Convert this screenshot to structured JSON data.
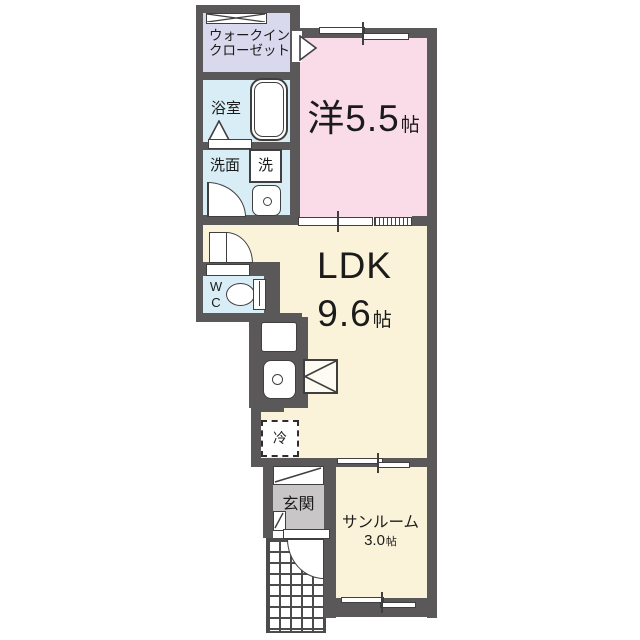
{
  "plan": {
    "type": "japanese-apartment-floorplan",
    "rooms": {
      "walk_in_closet": {
        "line1": "ウォークイン",
        "line2": "クローゼット"
      },
      "bathroom": {
        "label": "浴室"
      },
      "washroom": {
        "label": "洗面"
      },
      "washer": {
        "label": "洗"
      },
      "western_room": {
        "prefix": "洋",
        "size": "5.5",
        "unit": "帖"
      },
      "ldk": {
        "label": "LDK",
        "size": "9.6",
        "unit": "帖"
      },
      "wc": {
        "line1": "W",
        "line2": "C"
      },
      "refrigerator": {
        "label": "冷"
      },
      "entrance": {
        "label": "玄関"
      },
      "sunroom": {
        "label": "サンルーム",
        "size": "3.0",
        "unit": "帖"
      }
    },
    "colors": {
      "wall": "#5a5858",
      "western_room": "#fadce8",
      "ldk": "#faf3d9",
      "wet_area": "#d9edf6",
      "closet": "#d9d9ee",
      "entrance": "#c8c6c6",
      "background": "#ffffff",
      "text": "#1b1b1b"
    }
  }
}
